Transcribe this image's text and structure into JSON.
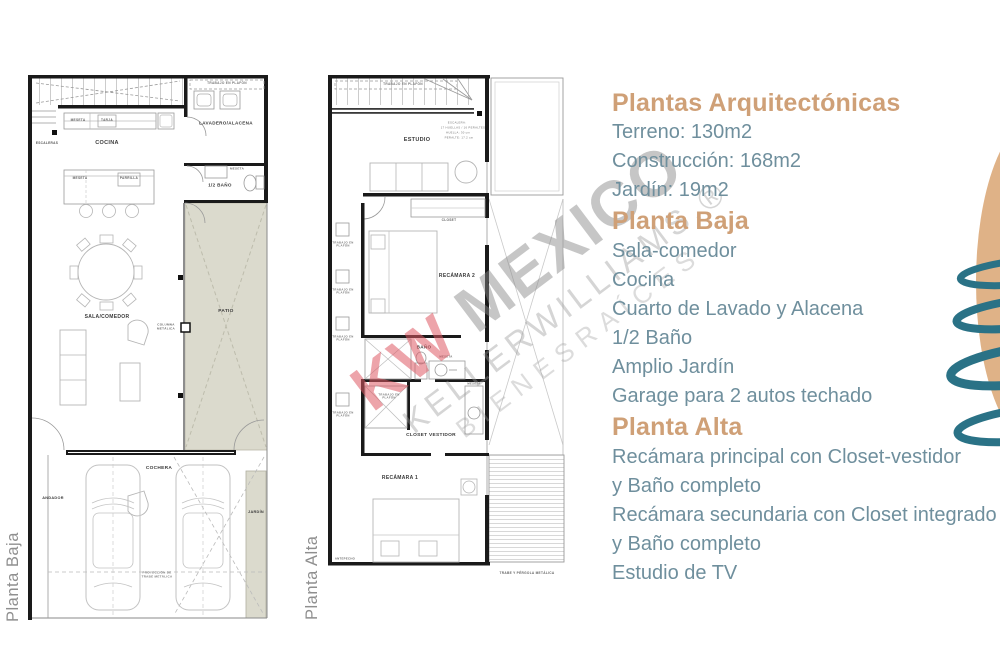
{
  "panel": {
    "title": "Plantas Arquitectónicas",
    "specs": [
      "Terreno: 130m2",
      "Construcción: 168m2",
      "Jardín: 19m2"
    ],
    "baja_heading": "Planta Baja",
    "baja_items": [
      "Sala-comedor",
      "Cocina",
      "Cuarto de Lavado y Alacena",
      "1/2 Baño",
      "Amplio Jardín",
      "Garage para 2 autos techado"
    ],
    "alta_heading": "Planta Alta",
    "alta_items": [
      "Recámara principal con Closet-vestidor",
      "y Baño completo",
      "Recámara secundaria con Closet integrado",
      "y Baño completo",
      "Estudio de TV"
    ]
  },
  "watermark": {
    "kw": "KW",
    "mexico": "MEXICO",
    "line2": "KELLERWILLIAMS.®",
    "line3": "BIENESRAÍCES"
  },
  "colors": {
    "accent_tan": "#cfa077",
    "text_teal": "#6f8f9d",
    "patio_beige": "#dbdacd",
    "logo_tan": "#dfb287",
    "logo_teal": "#2a7286",
    "watermark_pink": "#de5a64"
  },
  "plan_baja": {
    "side_label": "Planta Baja",
    "labels": {
      "escaleras": "ESCALERAS",
      "trabajo_plafon": "TRABAJO EN PLAFÓN",
      "lavadero": "LAVADERO/ALACENA",
      "cocina": "COCINA",
      "meseta": "MESETA",
      "tarja": "TARJA",
      "medio_bano": "1/2 BAÑO",
      "parrilla": "PARRILLA",
      "patio": "PATIO",
      "sala_comedor": "SALA/COMEDOR",
      "columna": "COLUMNA METÁLICA",
      "cochera": "COCHERA",
      "andador": "ANDADOR",
      "jardin": "JARDÍN",
      "proyeccion": "PROYECCIÓN DE TRABE METÁLICA"
    }
  },
  "plan_alta": {
    "side_label": "Planta Alta",
    "labels": {
      "trabajo_plafon": "TRABAJO EN PLAFÓN",
      "estudio": "ESTUDIO",
      "escalera_spec": [
        "ESCALERA:",
        "17 HUELLAS / 16 PERALTES",
        "HUELLA: 30 cm",
        "PERALTE: 17.2 cm"
      ],
      "closet": "CLOSET",
      "recamara2": "RECÁMARA 2",
      "bano": "BAÑO",
      "meseta": "MESETA",
      "closet_vestidor": "CLOSET VESTIDOR",
      "recamara1": "RECÁMARA 1",
      "antepecho": "ANTEPECHO",
      "trabe": "TRABE Y PÉRGOLA METÁLICA"
    }
  }
}
